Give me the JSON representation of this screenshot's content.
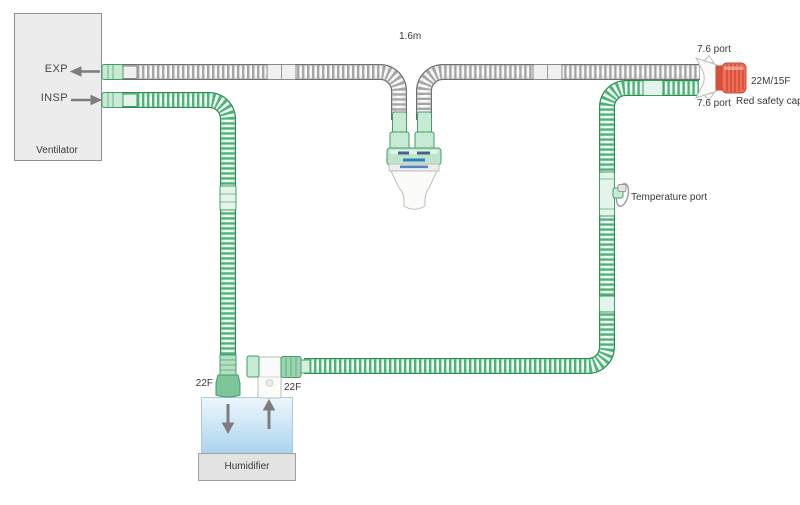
{
  "colors": {
    "green_outline": "#2e8a52",
    "green_body": "#e7f6ed",
    "green_ridge": "#4cb377",
    "green_highlight": "#f6fcf8",
    "gray_outline": "#6f6f6f",
    "gray_body": "#efefef",
    "gray_ridge": "#a6a6a6",
    "gray_highlight": "#fbfbfb",
    "cuff_fill": "#c8e9d3",
    "cuff_stroke": "#3f9e63",
    "red_cap": "#ef6d55",
    "red_cap_dark": "#c84936",
    "water_top": "#ecf6fc",
    "water_bottom": "#a9d3ee",
    "panel_fill": "#ececec",
    "panel_border": "#8f8f8f",
    "label_color": "#3a3a3a",
    "arrow_color": "#7d7d7d",
    "white_fill": "#fbfbf9",
    "white_stroke": "#bdbdbd"
  },
  "ventilator": {
    "title": "Ventilator",
    "exp_label": "EXP",
    "insp_label": "INSP"
  },
  "humidifier": {
    "title": "Humidifier",
    "inlet_label": "22F",
    "outlet_label": "22F"
  },
  "circuit": {
    "tube_length_label": "1.6m",
    "top_port_label": "7.6 port",
    "bottom_port_label": "7.6 port",
    "patient_connector_label": "22M/15F",
    "red_cap_label": "Red safety cap",
    "temperature_port_label": "Temperature port"
  }
}
